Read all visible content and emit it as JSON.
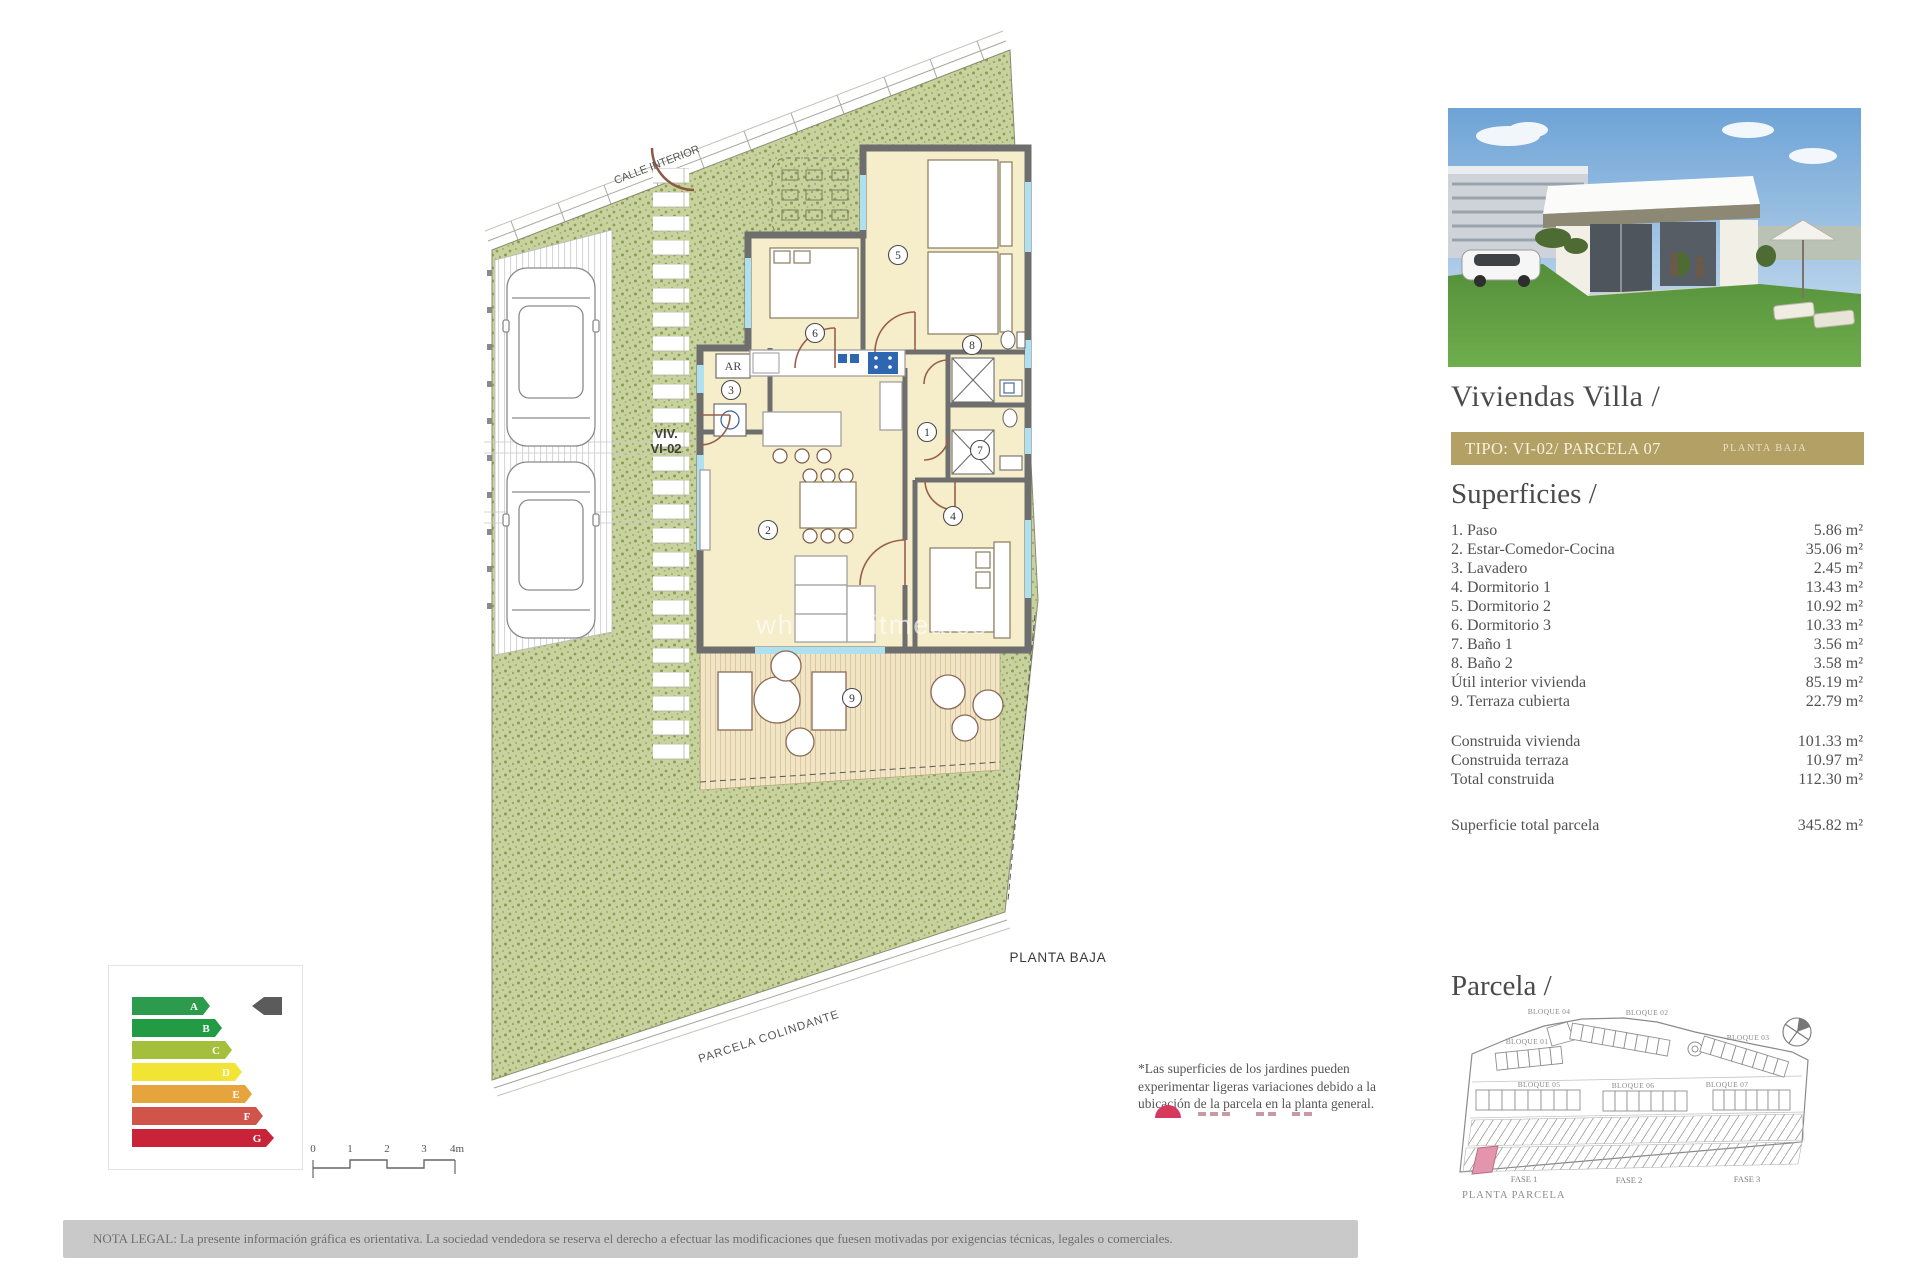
{
  "plan": {
    "labels": {
      "calle_interior": "CALLE INTERIOR",
      "viv_line1": "VIV.",
      "viv_line2": "VI-02",
      "planta_baja": "PLANTA BAJA",
      "parcela_colindante": "PARCELA COLINDANTE",
      "ar": "AR",
      "watermark": "whitedigitmeales"
    },
    "room_numbers": [
      "1",
      "2",
      "3",
      "4",
      "5",
      "6",
      "7",
      "8",
      "9"
    ]
  },
  "energy": {
    "letters": [
      "A",
      "B",
      "C",
      "D",
      "E",
      "F",
      "G"
    ],
    "colors": [
      "#2d9b4d",
      "#239a44",
      "#a3bf3b",
      "#f1e435",
      "#e6a53c",
      "#d1544a",
      "#c9233a"
    ],
    "cursor_color": "#5b5b5b"
  },
  "scalebar": {
    "ticks": [
      "0",
      "1",
      "2",
      "3",
      "4m"
    ]
  },
  "note": {
    "text": "*Las superficies de los jardines pueden experimentar ligeras variaciones debido a la ubicación de la parcela en la planta general."
  },
  "panel": {
    "title": "Viviendas Villa /",
    "tipo_bar": {
      "left": "TIPO: VI-02/ PARCELA 07",
      "right": "PLANTA BAJA",
      "bg": "#b2a065"
    },
    "superficies_heading": "Superficies /",
    "superficies": {
      "items": [
        {
          "label": "1. Paso",
          "value": "5.86 m²"
        },
        {
          "label": "2. Estar-Comedor-Cocina",
          "value": "35.06 m²"
        },
        {
          "label": "3. Lavadero",
          "value": "2.45 m²"
        },
        {
          "label": "4. Dormitorio 1",
          "value": "13.43 m²"
        },
        {
          "label": "5. Dormitorio 2",
          "value": "10.92 m²"
        },
        {
          "label": "6. Dormitorio 3",
          "value": "10.33 m²"
        },
        {
          "label": "7. Baño 1",
          "value": "3.56 m²"
        },
        {
          "label": "8. Baño 2",
          "value": "3.58 m²"
        },
        {
          "label": "Útil interior vivienda",
          "value": "85.19 m²"
        },
        {
          "label": "9. Terraza cubierta",
          "value": "22.79 m²"
        }
      ],
      "totals": [
        {
          "label": "Construida vivienda",
          "value": "101.33 m²"
        },
        {
          "label": "Construida terraza",
          "value": "10.97 m²"
        },
        {
          "label": "Total construida",
          "value": "112.30 m²"
        }
      ],
      "parcel_total": {
        "label": "Superficie total parcela",
        "value": "345.82 m²"
      }
    },
    "parcela_heading": "Parcela /",
    "parcela": {
      "bloques": {
        "b01": "BLOQUE 01",
        "b02": "BLOQUE 02",
        "b03": "BLOQUE 03",
        "b04": "BLOQUE 04",
        "b05": "BLOQUE 05",
        "b06": "BLOQUE 06",
        "b07": "BLOQUE 07"
      },
      "fases": [
        "FASE 1",
        "FASE 2",
        "FASE 3"
      ],
      "caption": "PLANTA PARCELA",
      "highlight_color": "#e295ad"
    }
  },
  "legal": {
    "text": "NOTA LEGAL: La presente información gráfica es orientativa. La sociedad vendedora se reserva el derecho a efectuar las modificaciones que fuesen motivadas por exigencias técnicas, legales o comerciales."
  }
}
